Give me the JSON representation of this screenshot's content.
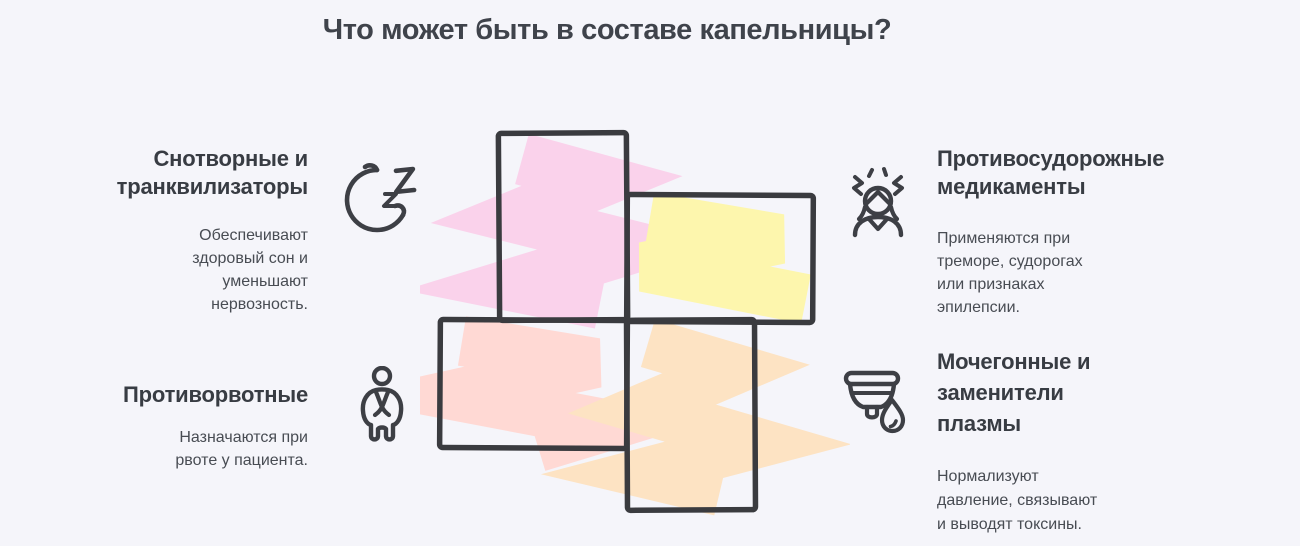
{
  "title": "Что может быть в составе капельницы?",
  "sections": [
    {
      "id": "sedatives",
      "heading": "Снотворные и\nтранквилизаторы",
      "description": "Обеспечивают\nздоровый сон и\nуменьшают\nнервозность.",
      "icon": "moon-zzz-icon"
    },
    {
      "id": "anticonvulsants",
      "heading": "Противосудорожные\nмедикаменты",
      "description": "Применяются при\nтреморе, судорогах\nили признаках\nэпилепсии.",
      "icon": "tremor-person-icon"
    },
    {
      "id": "antiemetics",
      "heading": "Противорвотные",
      "description": "Назначаются при\nрвоте у пациента.",
      "icon": "nausea-person-icon"
    },
    {
      "id": "plasma-diuretics",
      "heading": "Мочегонные и\nзаменители\nплазмы",
      "description": "Нормализуют\nдавление, связывают\nи выводят токсины.",
      "icon": "cup-droplet-icon"
    }
  ],
  "center_graphic": {
    "type": "pinwheel-cross",
    "panels": [
      {
        "name": "top",
        "color": "#fad2eb"
      },
      {
        "name": "right",
        "color": "#fdf6ad"
      },
      {
        "name": "left",
        "color": "#ffd9d4"
      },
      {
        "name": "bottom",
        "color": "#fde3c3"
      }
    ],
    "border_color": "#3a3b3f"
  },
  "colors": {
    "background": "#f5f5fa",
    "ink": "#3d3f45",
    "title_text": "#3f434b",
    "heading_text": "#383c43",
    "body_text": "#484c53"
  }
}
